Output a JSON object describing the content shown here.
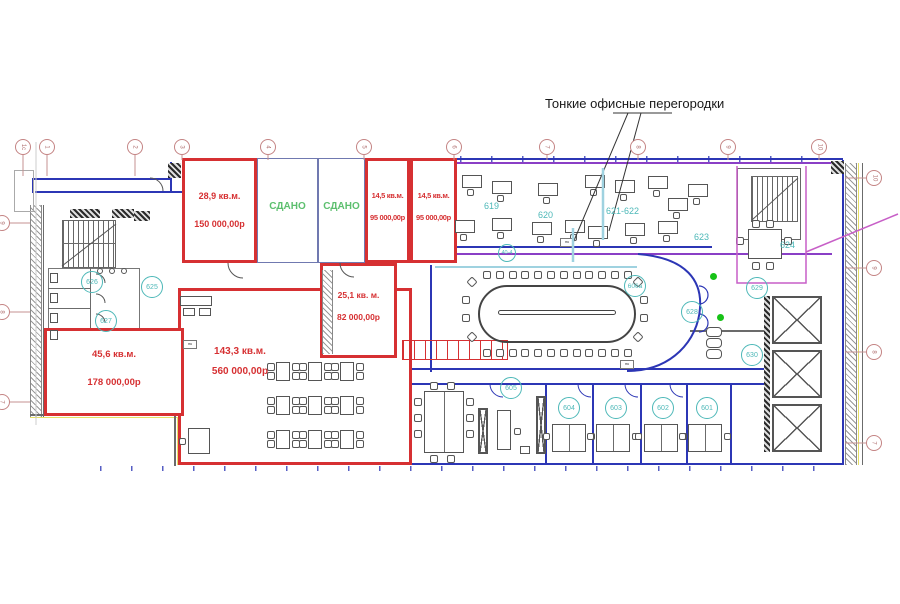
{
  "annotation": {
    "label": "Тонкие офисные перегородки"
  },
  "rent": {
    "r28": {
      "area": "28,9 кв.м.",
      "price": "150 000,00р"
    },
    "r14a": {
      "area": "14,5 кв.м.",
      "price": "95 000,00р"
    },
    "r14b": {
      "area": "14,5 кв.м.",
      "price": "95 000,00р"
    },
    "r25": {
      "area": "25,1 кв. м.",
      "price": "82 000,00р"
    },
    "r143": {
      "area": "143,3 кв.м.",
      "price": "560 000,00р"
    },
    "r45": {
      "area": "45,6 кв.м.",
      "price": "178 000,00р"
    }
  },
  "leased": {
    "a": "СДАНО",
    "b": "СДАНО"
  },
  "badges": {
    "b619": "619",
    "b620": "620",
    "b621": "621-622",
    "b623": "623",
    "b624": "624",
    "b625": "625",
    "b626": "626",
    "b627": "627",
    "b606": "606а",
    "b628": "628",
    "b629": "629",
    "b630": "630",
    "b605": "605",
    "b604": "604",
    "b603": "603",
    "b602": "602",
    "b601": "601",
    "bcorr": "40-4"
  },
  "grid": {
    "top": [
      "1с",
      "1",
      "2",
      "3",
      "4",
      "5",
      "6",
      "7",
      "8",
      "9",
      "10"
    ],
    "right": [
      "10",
      "9",
      "8",
      "7"
    ],
    "left": [
      "9",
      "8",
      "7"
    ]
  },
  "wall_tag": "пк",
  "colors": {
    "rent_outline": "#d63032",
    "leased_text": "#5cbf6e",
    "badge": "#4db8b8",
    "wall_blue": "#2c36b5",
    "wall_violet": "#8a3fc6",
    "wall_magenta": "#c75fc7"
  }
}
